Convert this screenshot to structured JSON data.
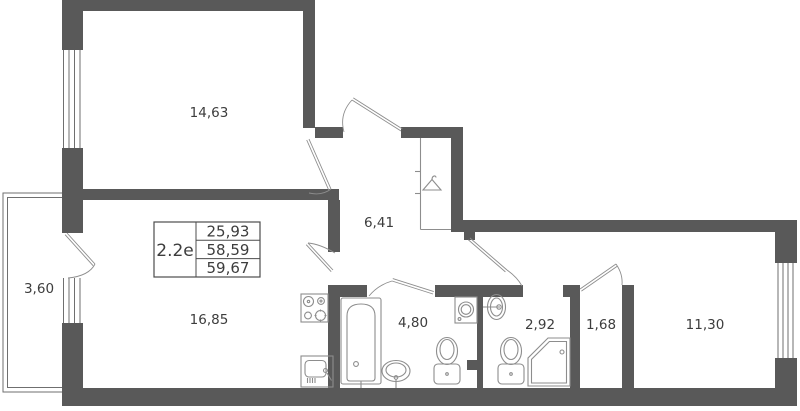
{
  "plan": {
    "unit_label": "2.2е",
    "area_table": {
      "rows": [
        "25,93",
        "58,59",
        "59,67"
      ]
    },
    "rooms": [
      {
        "name": "bedroom-top-left",
        "area": "14,63"
      },
      {
        "name": "hallway",
        "area": "6,41"
      },
      {
        "name": "balcony",
        "area": "3,60"
      },
      {
        "name": "living-kitchen",
        "area": "16,85"
      },
      {
        "name": "bathroom",
        "area": "4,80"
      },
      {
        "name": "toilet-room",
        "area": "2,92"
      },
      {
        "name": "storage",
        "area": "1,68"
      },
      {
        "name": "bedroom-right",
        "area": "11,30"
      }
    ],
    "fixtures": [
      "hanger",
      "bathtub",
      "bath-sink",
      "washing-machine",
      "toilet",
      "shower",
      "wc-sink",
      "toilet",
      "stove",
      "kitchen-sink"
    ],
    "colors": {
      "wall": "#595959",
      "fixture_line": "#8d8d8d",
      "window_line": "#6f6f6f",
      "door_line": "#8d8d8d",
      "text": "#3d3d3d",
      "table_border": "#4c4c4c",
      "background": "#ffffff"
    }
  }
}
